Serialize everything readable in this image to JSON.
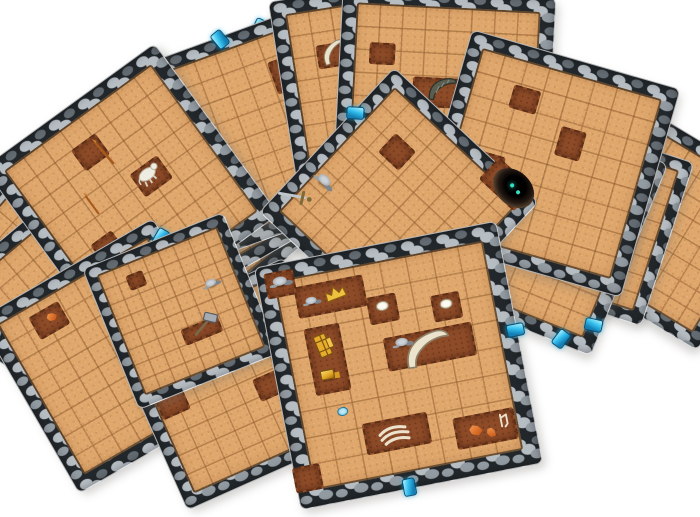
{
  "scene": {
    "background_color": "#ffffff",
    "subject": "pile of fanned-out square cardboard dungeon floor tiles with stone borders and sandy grid floors"
  },
  "palette": {
    "bg": "#ffffff",
    "stone_light": "#b6bdc3",
    "stone_mid": "#939ba2",
    "stone_dark": "#646c73",
    "mortar": "#22272b",
    "floor": "#dfa76c",
    "dirt": "#8d4b28",
    "gem": "#33bfee",
    "bone": "#ece3cd",
    "eye": "#35e0c0"
  },
  "tiles": [
    {
      "id": "dungeon-tile-1",
      "x": 138,
      "y": 66,
      "size": 200,
      "rot": -40,
      "z": 1,
      "features": [
        {
          "t": "gem",
          "x": 66,
          "y": 1,
          "rot": 40
        },
        {
          "t": "dirt",
          "x": 40,
          "y": 30,
          "w": 24,
          "h": 18
        }
      ]
    },
    {
      "id": "dungeon-tile-2",
      "x": 142,
      "y": 49,
      "size": 202,
      "rot": -30,
      "z": 2,
      "features": [
        {
          "t": "dirt",
          "x": 55,
          "y": 20,
          "w": 20,
          "h": 16
        },
        {
          "t": "dirt",
          "x": 38,
          "y": 38,
          "w": 30,
          "h": 22
        },
        {
          "t": "hole",
          "x": 40,
          "y": 40,
          "w": 34,
          "h": 26,
          "glow": "fire"
        },
        {
          "t": "gem",
          "x": 87,
          "y": 1,
          "rot": 55
        }
      ]
    },
    {
      "id": "dungeon-tile-3",
      "x": 141,
      "y": 34,
      "size": 205,
      "rot": -20,
      "z": 3,
      "features": [
        {
          "t": "dirt",
          "x": 78,
          "y": 28,
          "w": 18,
          "h": 30
        },
        {
          "t": "trident",
          "x": 78,
          "y": 26,
          "rot": 12
        },
        {
          "t": "gem",
          "x": 55,
          "y": 1,
          "rot": -20
        }
      ]
    },
    {
      "id": "dungeon-tile-4",
      "x": 283,
      "y": -16,
      "size": 208,
      "rot": -9,
      "z": 4,
      "features": [
        {
          "t": "dirt",
          "x": 27,
          "y": 30,
          "w": 30,
          "h": 20
        },
        {
          "t": "tusk",
          "x": 27,
          "y": 28,
          "rot": -25,
          "s": 0.8
        },
        {
          "t": "dirt",
          "x": 55,
          "y": 15,
          "w": 20,
          "h": 16
        }
      ]
    },
    {
      "id": "dungeon-tile-5",
      "x": -45,
      "y": 185,
      "size": 190,
      "rot": -58,
      "z": 1,
      "features": [
        {
          "t": "dirt",
          "x": 75,
          "y": 10,
          "w": 22,
          "h": 16
        }
      ]
    },
    {
      "id": "dungeon-tile-6",
      "x": -25,
      "y": 150,
      "size": 195,
      "rot": -49,
      "z": 2,
      "features": [
        {
          "t": "spear",
          "x": 80,
          "y": 14,
          "rot": -45,
          "s": 0.9
        }
      ]
    },
    {
      "id": "dungeon-tile-7",
      "x": -10,
      "y": 195,
      "size": 200,
      "rot": -40,
      "z": 3,
      "features": [
        {
          "t": "dirt",
          "x": 70,
          "y": 16,
          "w": 26,
          "h": 18
        }
      ]
    },
    {
      "id": "dungeon-tile-8",
      "x": 25,
      "y": 85,
      "size": 210,
      "rot": -36,
      "z": 4,
      "features": [
        {
          "t": "dirt",
          "x": 45,
          "y": 24,
          "w": 26,
          "h": 22
        },
        {
          "t": "spear",
          "x": 50,
          "y": 27,
          "rot": -55
        },
        {
          "t": "dirt",
          "x": 62,
          "y": 50,
          "w": 30,
          "h": 24
        },
        {
          "t": "rat",
          "x": 62,
          "y": 48
        },
        {
          "t": "spear",
          "x": 31,
          "y": 44,
          "rot": -50,
          "s": 0.8
        },
        {
          "t": "dirt",
          "x": 25,
          "y": 65,
          "w": 22,
          "h": 20
        }
      ]
    },
    {
      "id": "dungeon-tile-9",
      "x": 15,
      "y": 255,
      "size": 200,
      "rot": -30,
      "z": 5,
      "features": [
        {
          "t": "gem",
          "x": 99,
          "y": 10,
          "rot": 60
        },
        {
          "t": "gem",
          "x": 99,
          "y": 22,
          "rot": 60
        },
        {
          "t": "gem",
          "x": 99,
          "y": 34,
          "rot": 60
        },
        {
          "t": "dirt",
          "x": 30,
          "y": 18,
          "w": 30,
          "h": 22
        },
        {
          "t": "crystal",
          "x": 32,
          "y": 17,
          "s": 0.8
        }
      ]
    },
    {
      "id": "dungeon-tile-10",
      "x": 575,
      "y": 135,
      "size": 180,
      "rot": 31,
      "z": 4,
      "features": [
        {
          "t": "dirt",
          "x": 18,
          "y": 35,
          "w": 22,
          "h": 18
        },
        {
          "t": "gem",
          "x": 8,
          "y": 62,
          "rot": 60
        }
      ]
    },
    {
      "id": "dungeon-tile-11",
      "x": 337,
      "y": -8,
      "size": 212,
      "rot": 3,
      "z": 5,
      "features": [
        {
          "t": "dirt",
          "x": 50,
          "y": 47,
          "w": 60,
          "h": 26
        },
        {
          "t": "shell",
          "x": 49,
          "y": 45,
          "rot": -10
        },
        {
          "t": "dirt",
          "x": 20,
          "y": 30,
          "w": 22,
          "h": 18
        },
        {
          "t": "gem",
          "x": 28,
          "y": 99,
          "rot": 5
        }
      ]
    },
    {
      "id": "dungeon-tile-12",
      "x": 500,
      "y": 132,
      "size": 170,
      "rot": 18,
      "z": 5,
      "features": [
        {
          "t": "dirt",
          "x": 30,
          "y": 16,
          "w": 22,
          "h": 20
        },
        {
          "t": "dirt",
          "x": 69,
          "y": 31,
          "w": 22,
          "h": 20
        },
        {
          "t": "rune",
          "x": 69,
          "y": 30,
          "s": 0.9
        },
        {
          "t": "dirt",
          "x": 20,
          "y": 48,
          "w": 26,
          "h": 22
        },
        {
          "t": "dirt",
          "x": 45,
          "y": 60,
          "w": 20,
          "h": 18
        },
        {
          "t": "dirt",
          "x": 74,
          "y": 77,
          "w": 24,
          "h": 20
        },
        {
          "t": "lyre",
          "x": 73,
          "y": 76,
          "s": 0.9
        },
        {
          "t": "gem",
          "x": 22,
          "y": 0.5,
          "rot": -60
        }
      ]
    },
    {
      "id": "dungeon-tile-13",
      "x": 430,
      "y": 118,
      "size": 205,
      "rot": 22,
      "z": 6,
      "features": [
        {
          "t": "dirt",
          "x": 30,
          "y": 18,
          "w": 26,
          "h": 24
        },
        {
          "t": "tusk",
          "x": 31,
          "y": 17,
          "rot": 160,
          "s": 0.7
        },
        {
          "t": "dirt",
          "x": 78,
          "y": 28,
          "w": 22,
          "h": 20
        },
        {
          "t": "dirt",
          "x": 57,
          "y": 51,
          "w": 54,
          "h": 26
        },
        {
          "t": "snake",
          "x": 56,
          "y": 50
        },
        {
          "t": "dirt",
          "x": 18,
          "y": 74,
          "w": 48,
          "h": 24
        },
        {
          "t": "crystal",
          "x": 21,
          "y": 74,
          "s": 0.9
        },
        {
          "t": "gem",
          "x": 84,
          "y": 98,
          "rot": 15
        },
        {
          "t": "gem",
          "x": 96,
          "y": 86,
          "rot": 80
        }
      ]
    },
    {
      "id": "dungeon-tile-14",
      "x": 438,
      "y": 55,
      "size": 215,
      "rot": 16,
      "z": 6,
      "features": [
        {
          "t": "dirt",
          "x": 32,
          "y": 24,
          "w": 24,
          "h": 20
        },
        {
          "t": "dirt",
          "x": 58,
          "y": 38,
          "w": 22,
          "h": 26
        },
        {
          "t": "dirt",
          "x": 24,
          "y": 58,
          "w": 26,
          "h": 20
        },
        {
          "t": "gem",
          "x": 2,
          "y": 58,
          "rot": 75
        }
      ]
    },
    {
      "id": "dungeon-tile-15",
      "x": 300,
      "y": 108,
      "size": 196,
      "rot": 43,
      "z": 7,
      "features": [
        {
          "t": "dirt",
          "x": 82,
          "y": 4,
          "w": 44,
          "h": 26
        },
        {
          "t": "hole",
          "x": 86,
          "y": 3,
          "w": 46,
          "h": 34,
          "glow": "eyes"
        },
        {
          "t": "sword",
          "x": 8,
          "y": 82,
          "rot": 15
        },
        {
          "t": "rocks",
          "x": 13,
          "y": 66
        },
        {
          "t": "dirt",
          "x": 30,
          "y": 30,
          "w": 24,
          "h": 22
        },
        {
          "t": "gem",
          "x": 1,
          "y": 30,
          "rot": 50
        }
      ]
    },
    {
      "id": "dungeon-tile-16",
      "x": 140,
      "y": 288,
      "size": 190,
      "rot": -24,
      "z": 8,
      "features": [
        {
          "t": "dirt",
          "x": 44,
          "y": 15,
          "w": 120,
          "h": 25
        },
        {
          "t": "gold",
          "x": 63,
          "y": 14
        },
        {
          "t": "rocks",
          "x": 24,
          "y": 15
        },
        {
          "t": "dirt",
          "x": 15,
          "y": 45,
          "w": 26,
          "h": 22
        },
        {
          "t": "dirt",
          "x": 66,
          "y": 58,
          "w": 24,
          "h": 20
        }
      ]
    },
    {
      "id": "dungeon-tile-17",
      "x": 105,
      "y": 235,
      "size": 150,
      "rot": -22,
      "z": 9,
      "features": [
        {
          "t": "dirt",
          "x": 30,
          "y": 20,
          "w": 14,
          "h": 12
        },
        {
          "t": "dirt",
          "x": 58,
          "y": 67,
          "w": 36,
          "h": 13
        },
        {
          "t": "hammer",
          "x": 61,
          "y": 64,
          "rot": 25
        },
        {
          "t": "rocks",
          "x": 75,
          "y": 40,
          "s": 0.8
        }
      ]
    },
    {
      "id": "dungeon-tile-18",
      "x": 275,
      "y": 242,
      "size": 245,
      "rot": -11,
      "z": 10,
      "features": [
        {
          "t": "dirt",
          "x": 9,
          "y": 8,
          "w": 26,
          "h": 22
        },
        {
          "t": "rocks",
          "x": 9,
          "y": 7
        },
        {
          "t": "dirt",
          "x": 28,
          "y": 17,
          "w": 66,
          "h": 28
        },
        {
          "t": "crown",
          "x": 30,
          "y": 16,
          "rot": -10
        },
        {
          "t": "rocks",
          "x": 20,
          "y": 17,
          "s": 0.8
        },
        {
          "t": "dirt",
          "x": 22,
          "y": 42,
          "w": 32,
          "h": 64
        },
        {
          "t": "chest",
          "x": 22,
          "y": 36,
          "rot": 78
        },
        {
          "t": "gold",
          "x": 21,
          "y": 48
        },
        {
          "t": "dirt",
          "x": 48,
          "y": 26,
          "w": 26,
          "h": 24
        },
        {
          "t": "stone-white",
          "x": 48,
          "y": 25
        },
        {
          "t": "dirt",
          "x": 74,
          "y": 30,
          "w": 25,
          "h": 23
        },
        {
          "t": "stone-white",
          "x": 74,
          "y": 29
        },
        {
          "t": "dirt",
          "x": 64,
          "y": 45,
          "w": 86,
          "h": 30
        },
        {
          "t": "tusk",
          "x": 63,
          "y": 45,
          "rot": -8,
          "s": 1.4
        },
        {
          "t": "rocks",
          "x": 53,
          "y": 41,
          "s": 0.9
        },
        {
          "t": "pebble-blue",
          "x": 24,
          "y": 64
        },
        {
          "t": "dirt",
          "x": 44,
          "y": 77,
          "w": 62,
          "h": 28
        },
        {
          "t": "ribs",
          "x": 43,
          "y": 77,
          "rot": 10
        },
        {
          "t": "dirt",
          "x": 80,
          "y": 82,
          "w": 58,
          "h": 28
        },
        {
          "t": "crystal",
          "x": 76,
          "y": 82
        },
        {
          "t": "crystal",
          "x": 82,
          "y": 84,
          "rot": 35,
          "s": 0.8
        },
        {
          "t": "rune",
          "x": 88,
          "y": 80,
          "s": 0.9
        },
        {
          "t": "dirt",
          "x": 5,
          "y": 88,
          "w": 24,
          "h": 22
        },
        {
          "t": "gem",
          "x": 99.6,
          "y": 45,
          "rot": 90
        },
        {
          "t": "gem",
          "x": 45,
          "y": 99.6,
          "rot": 0
        }
      ]
    }
  ]
}
